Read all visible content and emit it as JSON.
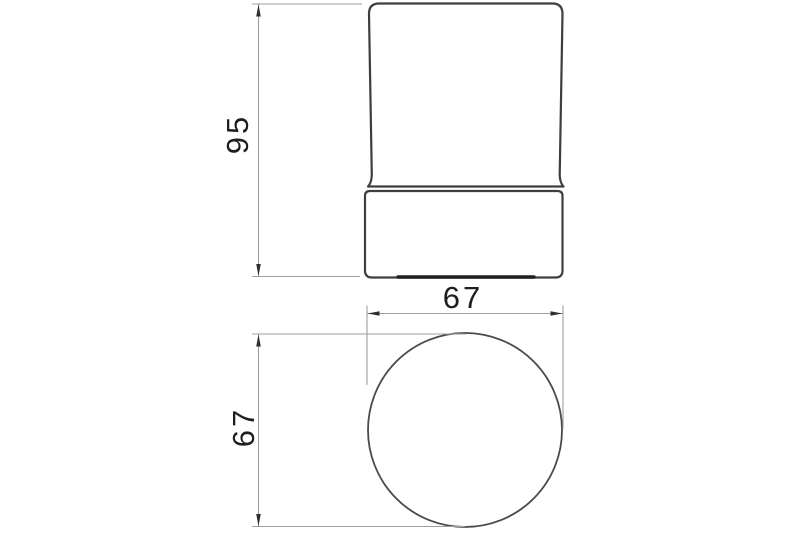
{
  "drawing": {
    "front_view": {
      "height_label": "95"
    },
    "top_view": {
      "width_label": "67",
      "depth_label": "67"
    }
  },
  "colors": {
    "background": "#ffffff",
    "object_line": "#3e3e3e",
    "circle_line": "#4a4a4a",
    "dimension_line": "#9e9e9e",
    "arrow": "#2e2e2e",
    "base_recess": "#1f1f1f",
    "text": "#1e1e1e"
  }
}
